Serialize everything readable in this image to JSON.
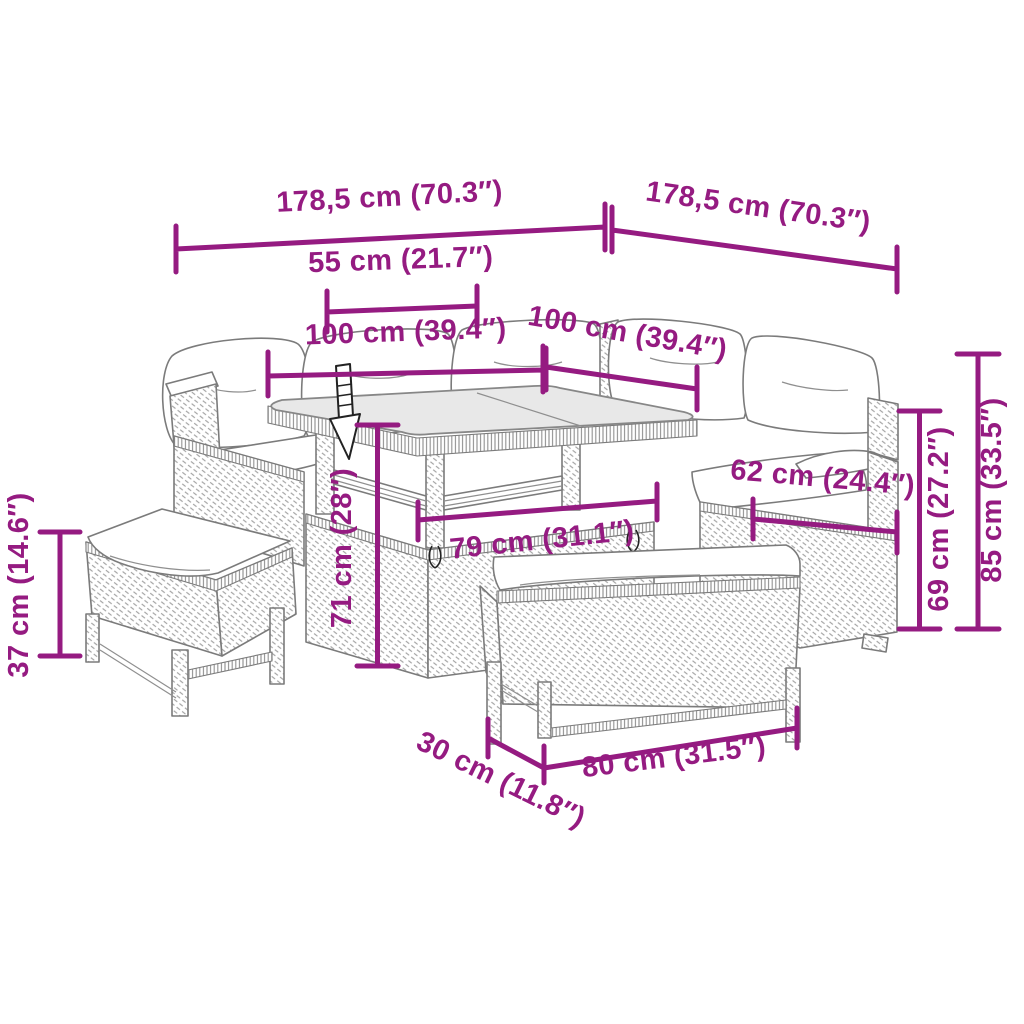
{
  "figure": {
    "kind": "product-dimension-diagram",
    "subject": "rattan garden lounge set: corner sofa with cushions, square glass-top table, two benches",
    "colors": {
      "dimension_accent": "#951B81",
      "line_art": "#7b7b7b",
      "glass_top": "#e8e8e8",
      "cushions": "#ffffff",
      "adjust_arrow": "#222222",
      "background": "#ffffff"
    }
  },
  "dimensions": {
    "sofa_side_left_total": {
      "label": "178,5 cm (70.3″)",
      "cm": "178,5",
      "inch": "70.3"
    },
    "sofa_side_right_total": {
      "label": "178,5 cm (70.3″)",
      "cm": "178,5",
      "inch": "70.3"
    },
    "table_top_section": {
      "label": "55 cm (21.7″)",
      "cm": "55",
      "inch": "21.7"
    },
    "table_top_left": {
      "label": "100 cm (39.4″)",
      "cm": "100",
      "inch": "39.4"
    },
    "table_top_right": {
      "label": "100 cm (39.4″)",
      "cm": "100",
      "inch": "39.4"
    },
    "table_height": {
      "label": "71 cm (28″)",
      "cm": "71",
      "inch": "28"
    },
    "inner_seat_width": {
      "label": "79 cm (31.1″)",
      "cm": "79",
      "inch": "31.1"
    },
    "seat_depth": {
      "label": "62 cm (24.4″)",
      "cm": "62",
      "inch": "24.4"
    },
    "arm_height": {
      "label": "69 cm (27.2″)",
      "cm": "69",
      "inch": "27.2"
    },
    "total_height": {
      "label": "85 cm (33.5″)",
      "cm": "85",
      "inch": "33.5"
    },
    "bench_height": {
      "label": "37 cm (14.6″)",
      "cm": "37",
      "inch": "14.6"
    },
    "bench_depth": {
      "label": "30 cm (11.8″)",
      "cm": "30",
      "inch": "11.8"
    },
    "bench_width": {
      "label": "80 cm (31.5″)",
      "cm": "80",
      "inch": "31.5"
    }
  }
}
